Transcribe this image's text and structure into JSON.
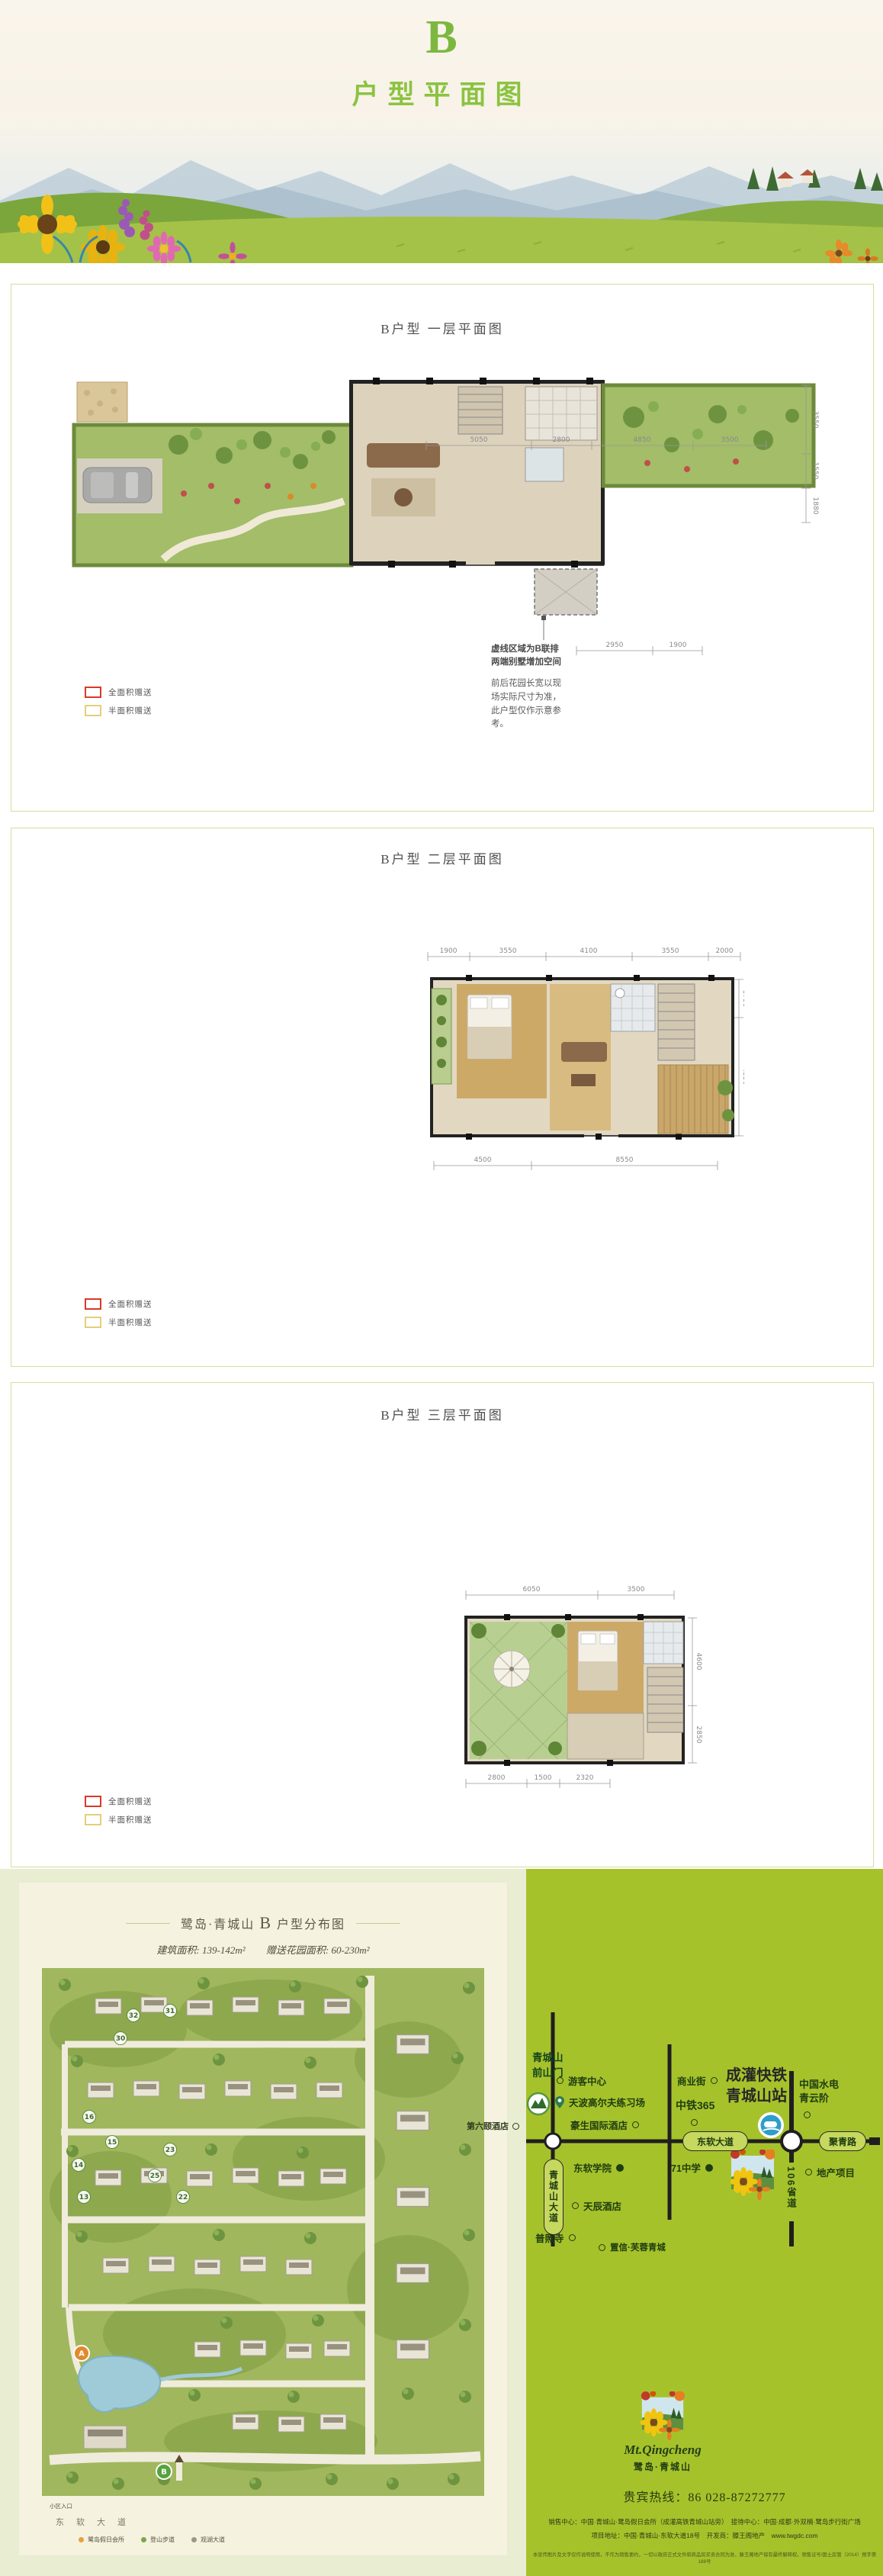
{
  "header": {
    "letter": "B",
    "title": "户型平面图"
  },
  "sections": {
    "s1": "B户型 一层平面图",
    "s2": "B户型 二层平面图",
    "s3": "B户型 三层平面图"
  },
  "legend": {
    "full": "全面积赠送",
    "half": "半面积赠送"
  },
  "floor1": {
    "dims_top": [
      "5050",
      "2800",
      "4850",
      "3500"
    ],
    "dims_bottom": [
      "2950",
      "1900"
    ],
    "dims_right": [
      "3550",
      "1550",
      "1880"
    ],
    "note_dash1": "虚线区域为B联排",
    "note_dash2": "两端别墅增加空间",
    "note_garden": "前后花园长宽以现场实际尺寸为准，此户型仅作示意参考。"
  },
  "floor2": {
    "dims_top": [
      "1900",
      "3550",
      "4100",
      "3550",
      "2000"
    ],
    "dims_bottom": [
      "4500",
      "8550"
    ],
    "dims_right": [
      "1750",
      "4350"
    ]
  },
  "floor3": {
    "dims_top": [
      "6050",
      "3500"
    ],
    "dims_bottom": [
      "2800",
      "1500",
      "2320"
    ],
    "dims_right": [
      "4600",
      "2850"
    ]
  },
  "sitemap": {
    "title_pre": "鹭岛·青城山",
    "title_b": "B",
    "title_post": "户型分布图",
    "area_label": "建筑面积: 139-142m²",
    "garden_label": "赠送花园面积: 60-230m²",
    "plots": [
      "32",
      "31",
      "30",
      "16",
      "15",
      "14",
      "23",
      "25",
      "13",
      "22"
    ],
    "marker_a": "A",
    "marker_b": "B",
    "entrance": "小区入口",
    "road": "东软大道",
    "legend": [
      {
        "label": "鹭岛假日会所"
      },
      {
        "label": "登山步道"
      },
      {
        "label": "观湖大道"
      }
    ]
  },
  "diagram": {
    "gate1": "青城山",
    "gate2": "前山门",
    "visitor_center": "游客中心",
    "golf": "天波高尔夫练习场",
    "hotel_howard": "豪生国际酒店",
    "hotel_sixth": "第六颐酒店",
    "biz_street": "商业街",
    "zhongtie": "中铁365",
    "rail_line1": "成灌快铁",
    "rail_line2": "青城山站",
    "hydro1": "中国水电",
    "hydro2": "青云阶",
    "road_dongruan": "东软大道",
    "road_qingchengshan": "青城山大道",
    "road_juqing": "聚青路",
    "road_s106": "106省道",
    "college": "东软学院",
    "school71": "71中学",
    "estate": "地产项目",
    "hotel_tianchen": "天辰酒店",
    "temple": "普照寺",
    "zhixin": "置信·芙蓉青城"
  },
  "footer": {
    "logo_en": "Mt.Qingcheng",
    "logo_cn": "鹭岛·青城山",
    "hotline": "贵宾热线：86 028-87272777",
    "addr1": "销售中心：中国·青城山·鹭岛假日会所（成灌高铁青城山站旁）　接待中心：中国·成都·外双楠·鹭岛步行街广场",
    "addr2": "项目地址：中国·青城山·东软大道18号　开发商：滕王阁地产　www.twgdc.com",
    "disclaimer": "本宣传图片及文字仅作说明使用，不作为销售要约，一切以政府正式文件和商品房买卖合同为准，滕王阁地产保有最终解释权。预售证号/国土房管（2014）预字第188号"
  },
  "icons": {
    "ring": "ring-marker-icon",
    "dot": "filled-dot-marker-icon",
    "pin": "location-pin-icon",
    "train": "train-station-icon",
    "gate": "mountain-gate-icon",
    "flower_logo": "flower-logo"
  },
  "colors": {
    "accent_green": "#7cb840",
    "panel_green": "#a6c22b",
    "legend_full": "#d93a2b",
    "legend_half": "#e3cf7a"
  }
}
